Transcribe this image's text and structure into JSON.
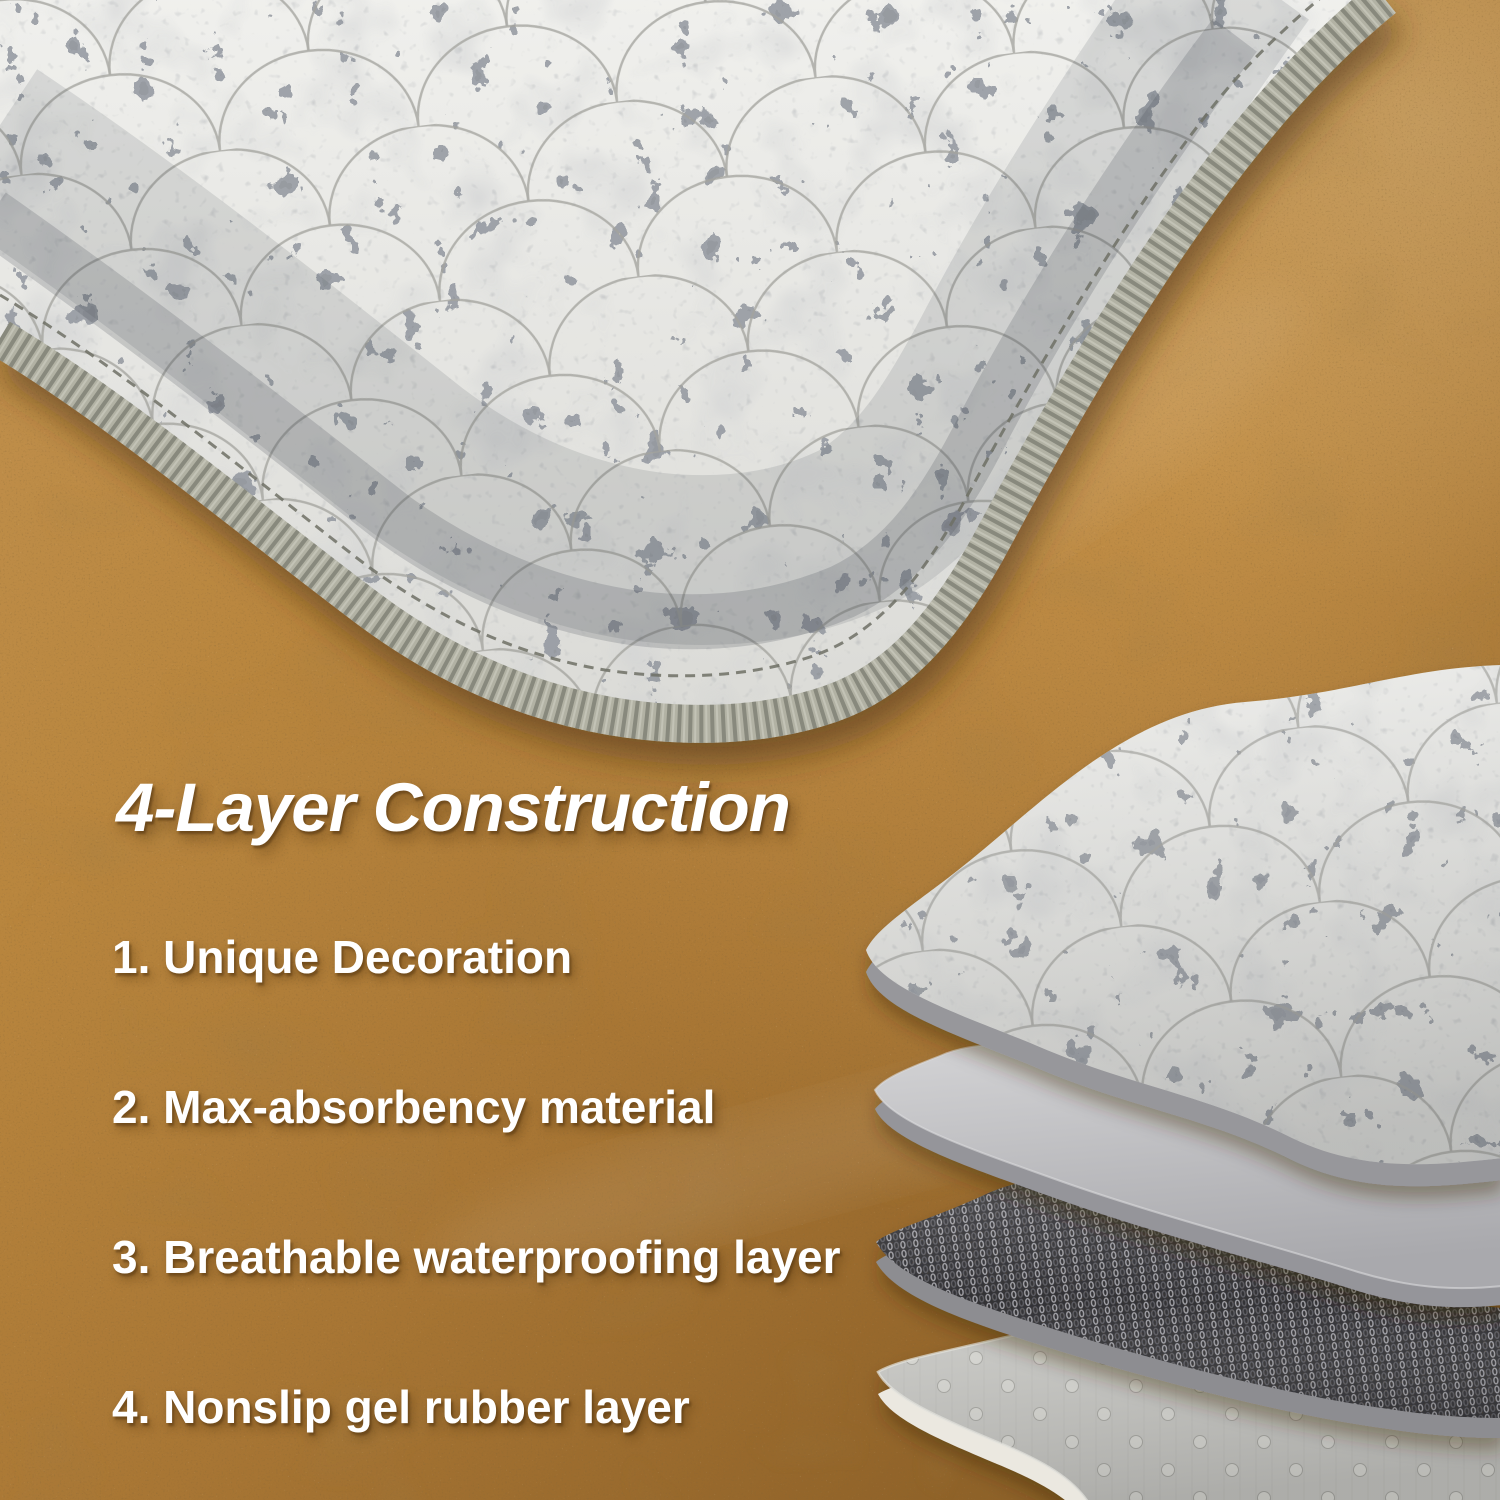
{
  "overlay": {
    "title": "4-Layer Construction",
    "items": [
      "1. Unique Decoration",
      "2. Max-absorbency material",
      "3. Breathable waterproofing layer",
      "4. Nonslip gel rubber layer"
    ]
  },
  "colors": {
    "text": "#ffffff",
    "floor_amber": "#b9863e",
    "floor_dark": "#7c5520",
    "floor_light": "#c39453",
    "mat_fabric_light": "#ebebe8",
    "mat_print_dark": "#474b54",
    "serge_edge": "#b2b2a4",
    "layer2_gray": "#c6c7c9",
    "layer3_charcoal": "#313135",
    "layer4_dotted": "#c9c9c5",
    "layer4_underside": "#ebe8e0"
  }
}
